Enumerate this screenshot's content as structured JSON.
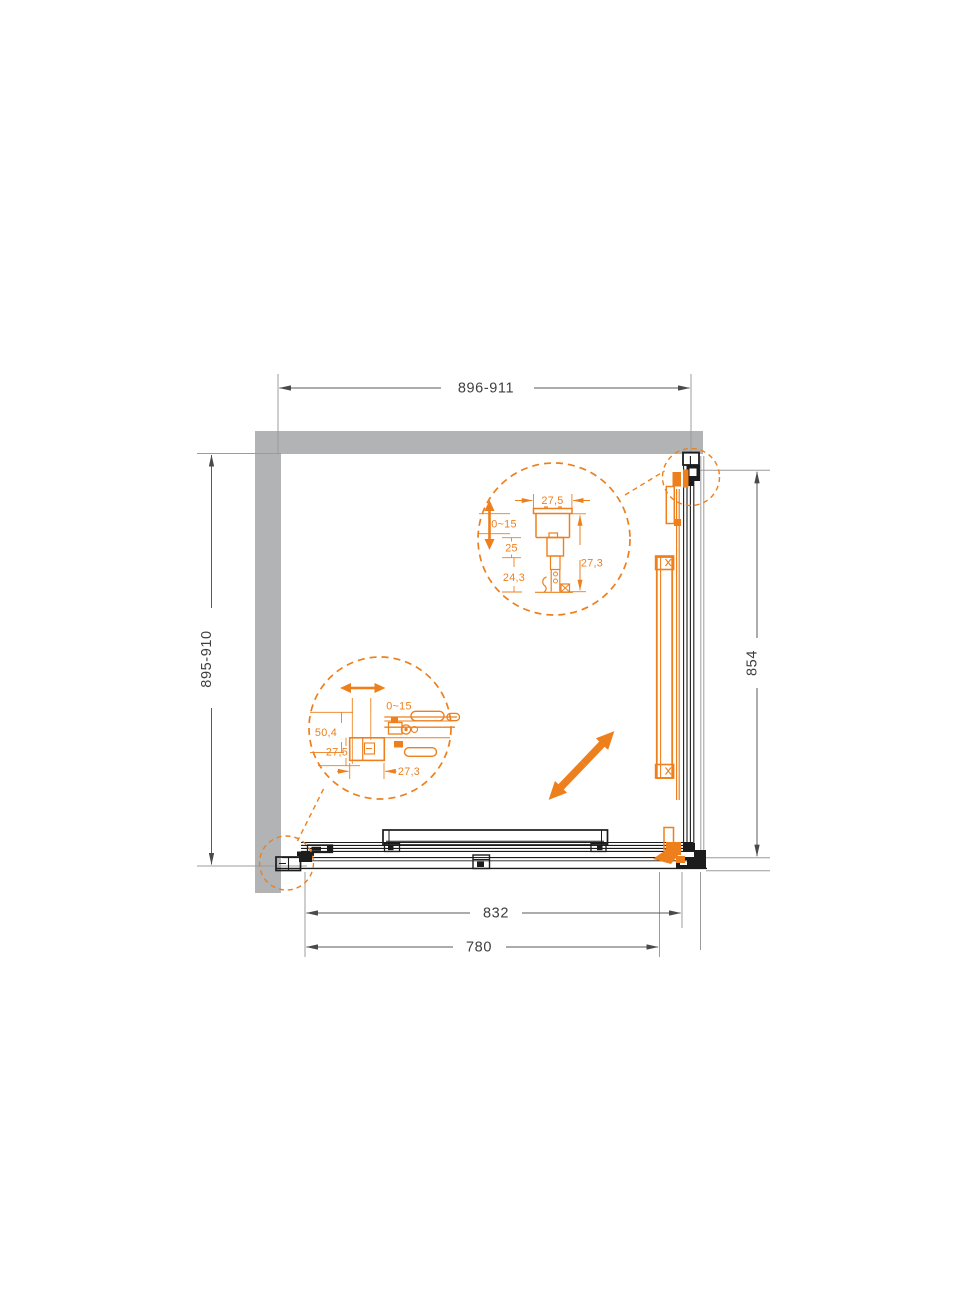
{
  "drawing": {
    "type": "shower-enclosure-plan-technical-drawing",
    "colors": {
      "accent": "#ee7f1d",
      "wall": "#b1b3b4",
      "line": "#1c1c1c",
      "dimension": "#3f3f3f"
    },
    "dimensions": {
      "top": "896-911",
      "left": "895-910",
      "right": "854",
      "bottom_outer": "832",
      "bottom_inner": "780"
    },
    "detail_top": {
      "width": "27,5",
      "travel": "0~15",
      "upper": "25",
      "lower": "24,3",
      "depth": "27,3"
    },
    "detail_bottom": {
      "travel": "0~15",
      "height": "50,4",
      "block": "27,5",
      "width": "27,3"
    }
  }
}
